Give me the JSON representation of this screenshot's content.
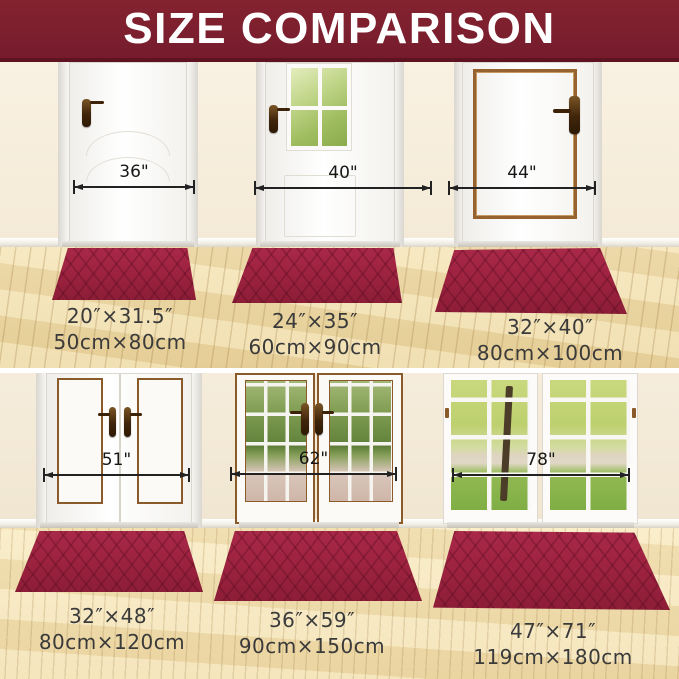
{
  "header": {
    "title": "SIZE COMPARISON"
  },
  "panels": [
    {
      "name": "single-panel-door",
      "arrow_label": "36\"",
      "size_inches": "20″×31.5″",
      "size_cm": "50cm×80cm"
    },
    {
      "name": "half-glass-door",
      "arrow_label": "40\"",
      "size_inches": "24″×35″",
      "size_cm": "60cm×90cm"
    },
    {
      "name": "copper-trim-door",
      "arrow_label": "44\"",
      "size_inches": "32″×40″",
      "size_cm": "80cm×100cm"
    },
    {
      "name": "double-panel-door",
      "arrow_label": "51\"",
      "size_inches": "32″×48″",
      "size_cm": "80cm×120cm"
    },
    {
      "name": "french-doors",
      "arrow_label": "62\"",
      "size_inches": "36″×59″",
      "size_cm": "90cm×150cm"
    },
    {
      "name": "patio-glass-doors",
      "arrow_label": "78\"",
      "size_inches": "47″×71″",
      "size_cm": "119cm×180cm"
    }
  ],
  "colors": {
    "banner": "#7a1e2e",
    "mat": "#9e2340",
    "wall": "#f6eedd",
    "floor": "#edd9a6",
    "label_text": "#3a3a3a"
  }
}
